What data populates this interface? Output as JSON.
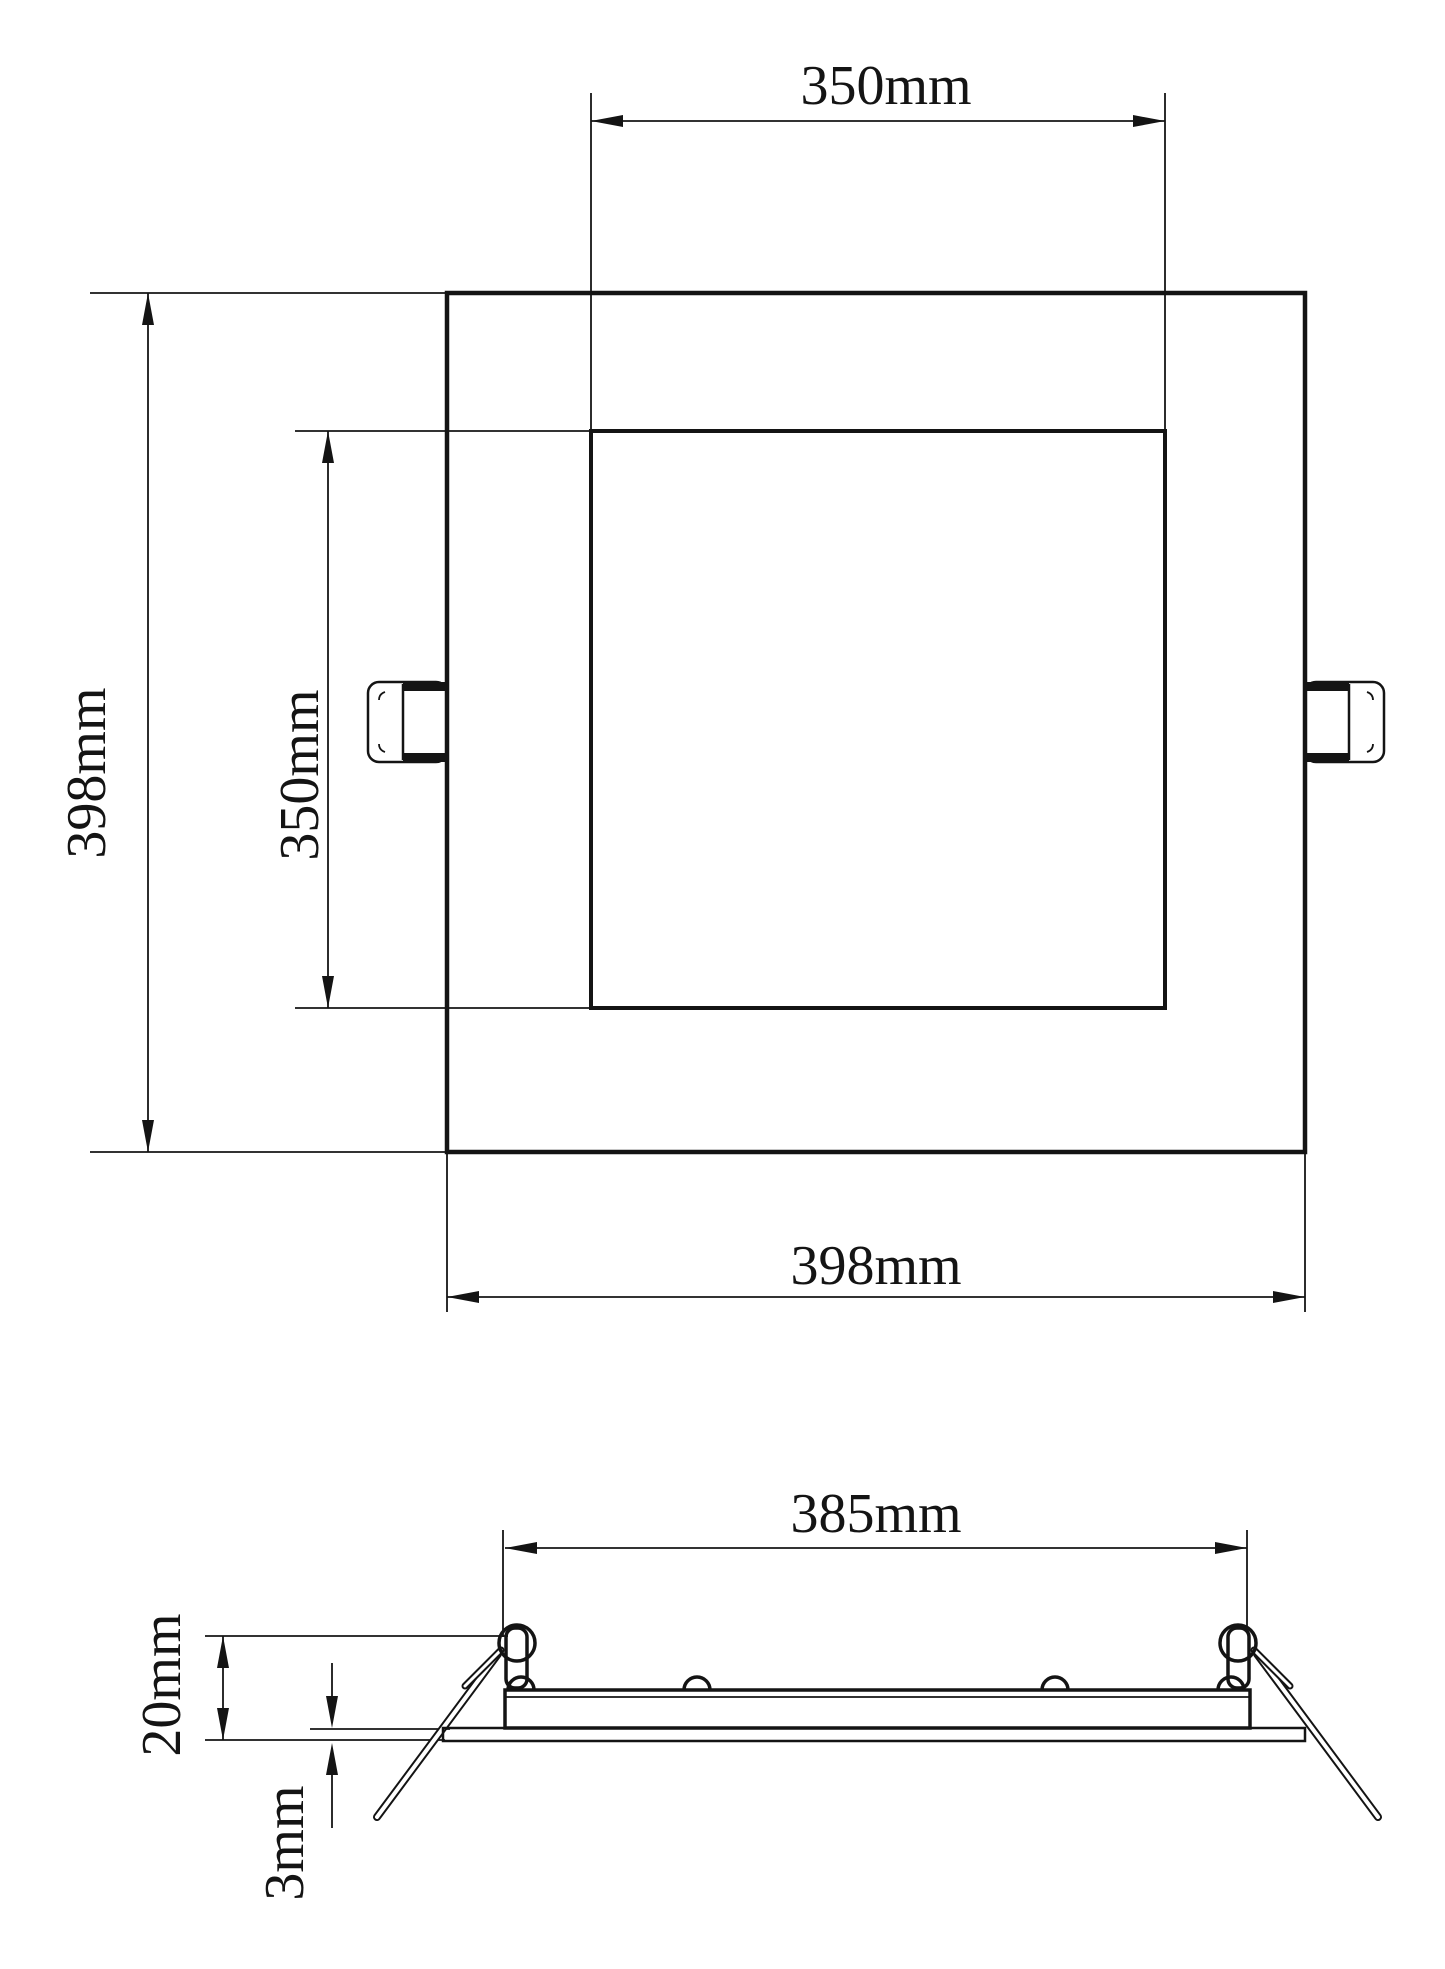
{
  "diagram": {
    "type": "technical-drawing",
    "views": {
      "front_view": {
        "dim_top_inner_width": "350mm",
        "dim_left_outer_height": "398mm",
        "dim_left_inner_height": "350mm",
        "dim_bottom_outer_width": "398mm"
      },
      "side_view": {
        "dim_cutout_width": "385mm",
        "dim_recess_height": "20mm",
        "dim_flange_thickness": "3mm"
      }
    },
    "colors": {
      "line": "#141414",
      "background": "#ffffff"
    }
  }
}
